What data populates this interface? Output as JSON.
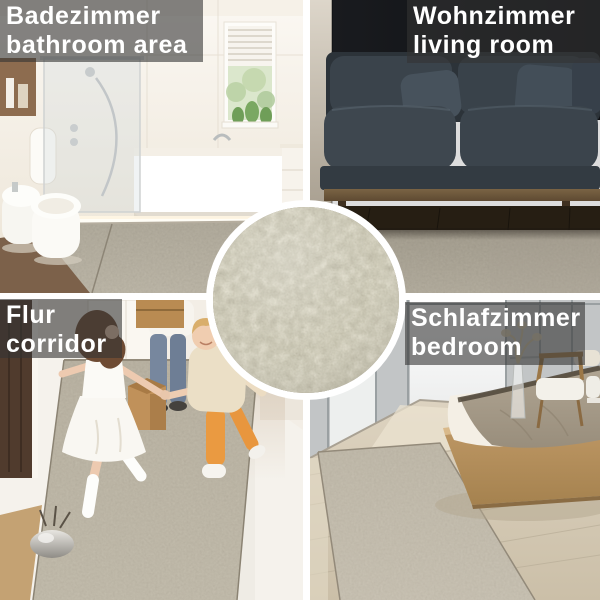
{
  "theme": {
    "overlay-bg": "rgba(52,52,52,0.60)",
    "label-text": "#ffffff",
    "divider": "#ffffff",
    "carpet-light": "#d8d2c2",
    "carpet-mid": "#a49c8a",
    "carpet-dark": "#7b745f"
  },
  "quadrants": [
    {
      "id": "bathroom",
      "label_de": "Badezimmer",
      "label_en": "bathroom area",
      "scene": "bright bathroom with shower, bathtub, window and beige rug"
    },
    {
      "id": "living-room",
      "label_de": "Wohnzimmer",
      "label_en": "living room",
      "scene": "dark gray sofa on wood floor with beige rug"
    },
    {
      "id": "corridor",
      "label_de": "Flur",
      "label_en": "corridor",
      "scene": "two children running on beige runner rug, parents with moving boxes"
    },
    {
      "id": "bedroom",
      "label_de": "Schlafzimmer",
      "label_en": "bedroom",
      "scene": "platform bed, chairs and beige rug on light wood floor"
    }
  ],
  "center_inset": {
    "name": "carpet-pile-closeup"
  }
}
